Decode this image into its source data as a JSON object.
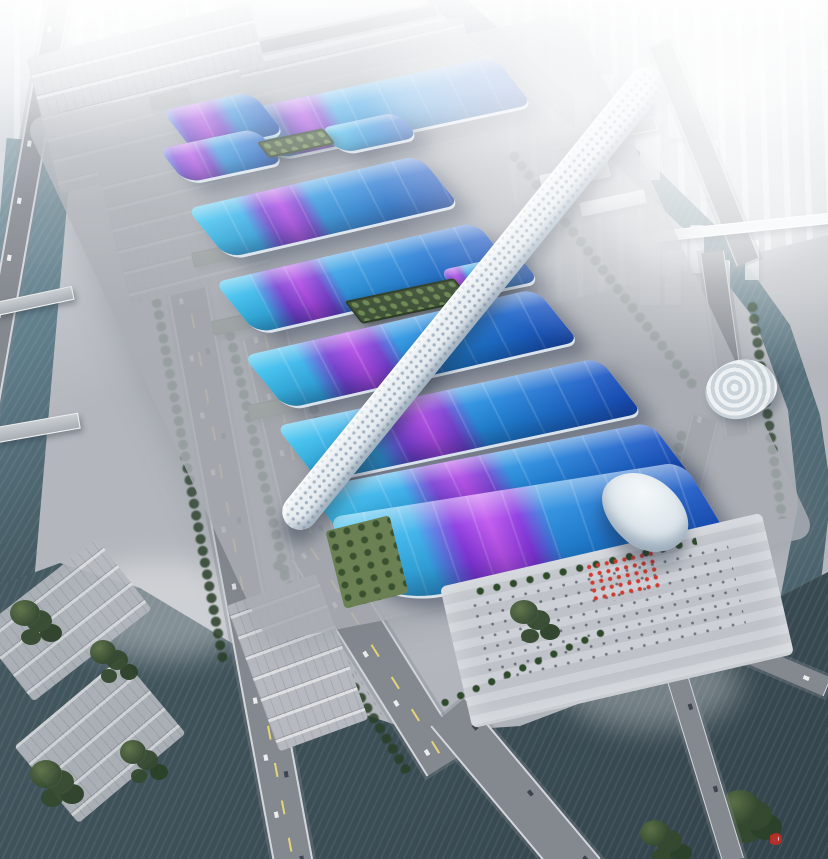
{
  "scene": {
    "type": "aerial architectural rendering",
    "subject": "riverside exhibition and convention center complex",
    "view": "bird's-eye oblique view",
    "atmosphere": "hazy daylight, surrounding city fading into white fog"
  },
  "complex": {
    "spine": "white lattice central concourse running diagonally through all halls",
    "hall_rows": 8,
    "offset_halls": 3,
    "grand_hall": "south grand hall with wave-edged roof and shell-shaped entrance canopy",
    "roof_motif": "cyan-to-blue gradient roofs crossed by a sweeping purple ribbon",
    "rooftop_gardens": 2,
    "entrance_plaza": "striped forecourt with palm trees, visitors and red banner decorations"
  },
  "environment": {
    "west": "elevated expressway, tree-lined boulevard, truck depots and warehouses, canal with bridges",
    "east": "curved riverside road, spiral pavilion, canal with road and pedestrian bridges, high-rise towers",
    "north": "dome venue, parking lots with trucks, city blocks in haze",
    "south": "wide river, road bridges, waterfront park with terraces and trees"
  },
  "colors": {
    "skyHaze": "#e3e8ec",
    "ground": "#b3b7bd",
    "apron": "#a9adb3",
    "road": "#84888f",
    "laneYellow": "#e6d478",
    "waterDark": "#3f525a",
    "waterCanal": "#5f7d8a",
    "waterLight": "#7d97a2",
    "treeDark": "#33492e",
    "treeLight": "#5d7247",
    "lawn": "#6c8153",
    "gardenRoof": "#41543a",
    "shedRoof": "#5d6b4d",
    "roofCyan": "#3cc2ee",
    "roofBlue": "#2286dc",
    "roofDeep": "#1b50c0",
    "ribbonPurple": "#7d3bd2",
    "ribbonMagenta": "#b844e6",
    "spineWhite": "#e9eef2",
    "shellWhite": "#f4f8fa",
    "red": "#d03a30",
    "watermarkRed": "#cc2b24"
  },
  "watermark": {
    "symbol": "D"
  }
}
